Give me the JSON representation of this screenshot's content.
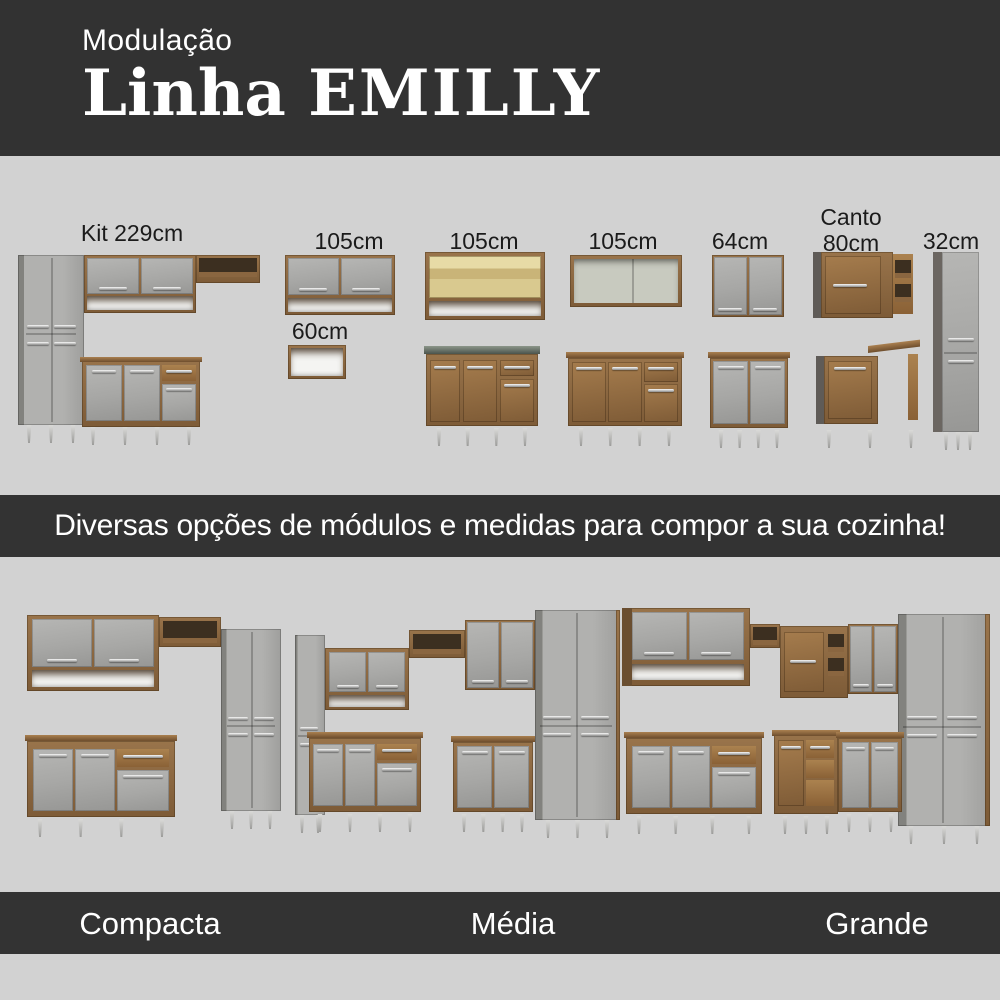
{
  "header": {
    "eyebrow": "Modulação",
    "line_word": "Linha",
    "model_word": "EMILLY"
  },
  "modules": {
    "items": [
      {
        "id": "kit-229cm",
        "label": "Kit 229cm"
      },
      {
        "id": "wall-105cm",
        "label": "105cm"
      },
      {
        "id": "niche-60cm",
        "label": "60cm"
      },
      {
        "id": "glass-105cm",
        "label": "105cm"
      },
      {
        "id": "open-105cm",
        "label": "105cm"
      },
      {
        "id": "wall-64cm",
        "label": "64cm"
      },
      {
        "id": "corner-80cm",
        "label": "Canto\n80cm"
      },
      {
        "id": "tall-32cm",
        "label": "32cm"
      }
    ]
  },
  "banner": {
    "text": "Diversas opções de módulos e medidas para compor a sua cozinha!"
  },
  "kitchens": [
    {
      "name": "Compacta"
    },
    {
      "name": "Média"
    },
    {
      "name": "Grande"
    }
  ],
  "colors": {
    "header_bg": "#323232",
    "ribbon_bg": "#333333",
    "section_bg": "#d2d2d2",
    "wood": "#8a6640",
    "door_gray": "#a9a9a7",
    "sink_top": "#4b544c",
    "text_light": "#ffffff",
    "text_dark": "#1b1b1b"
  }
}
